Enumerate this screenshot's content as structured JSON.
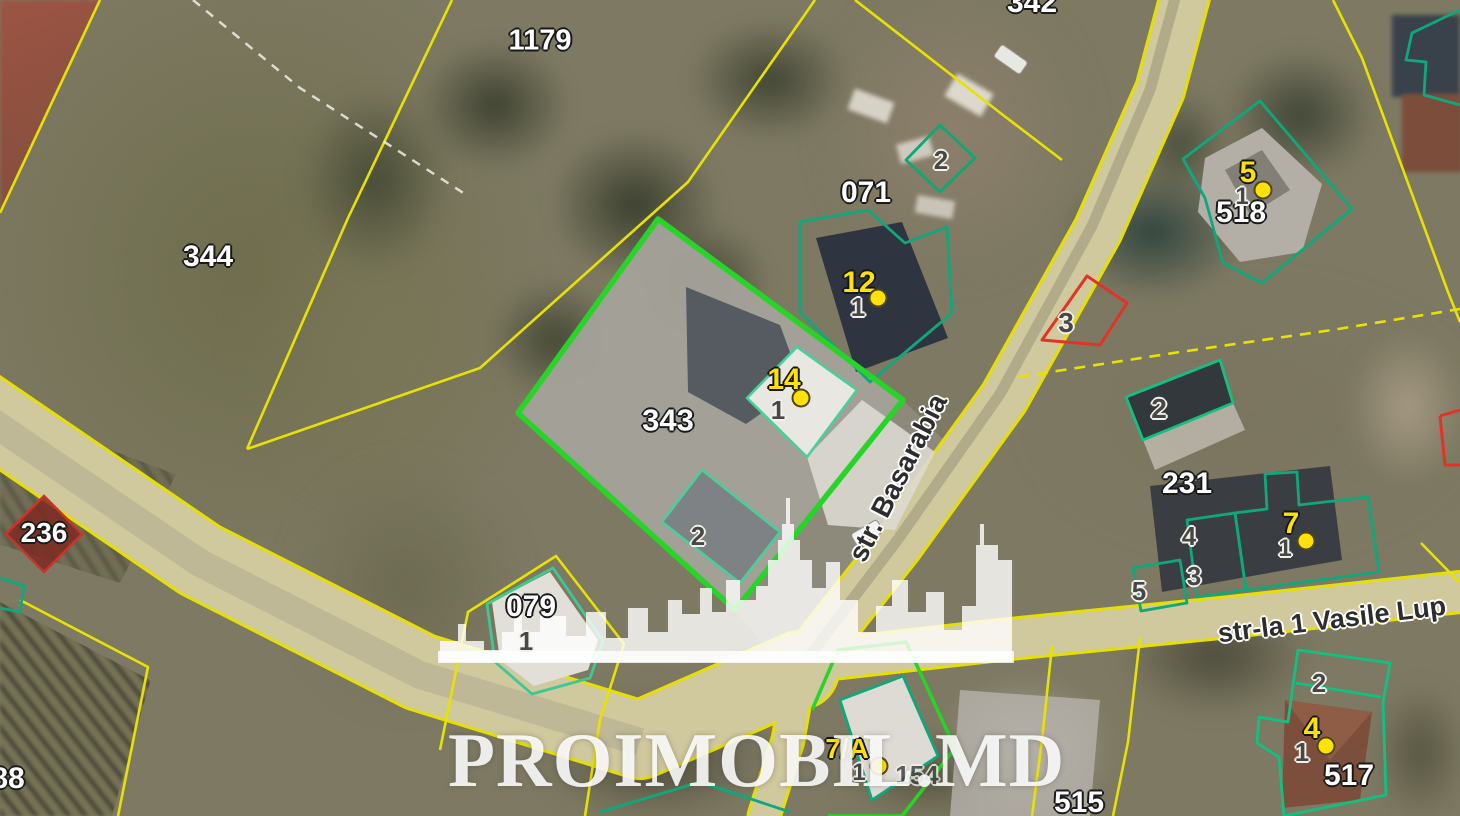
{
  "map_type": "cadastral-satellite-view",
  "watermark": {
    "text": "PROIMOBIL.MD"
  },
  "streets": {
    "basarabia": "str. Basarabia",
    "vasile_lupu": "str-la 1 Vasile Lup"
  },
  "parcels": {
    "p1179": "1179",
    "p344": "344",
    "p342": "342",
    "p071": "071",
    "p343": "343",
    "p518": "518",
    "p231": "231",
    "p079": "079",
    "p236": "236",
    "p515": "515",
    "p517": "517",
    "p88": "88"
  },
  "sub_labels": {
    "s1_079": "1",
    "s2_343": "2",
    "s1_14": "1",
    "s1_12": "1",
    "s2_071": "2",
    "s1_5": "1",
    "s3_red": "3",
    "s2_231": "2",
    "s4_231": "4",
    "s3_231": "3",
    "s5_231": "5",
    "s1_7": "1",
    "s2_517": "2",
    "s1_4": "1",
    "s1_7a": "1",
    "s154": "154"
  },
  "markers": {
    "m12": {
      "label": "12"
    },
    "m14": {
      "label": "14"
    },
    "m5": {
      "label": "5"
    },
    "m7": {
      "label": "7"
    },
    "m4": {
      "label": "4"
    },
    "m7a": {
      "label": "7/A"
    }
  },
  "colors": {
    "parcel_line_yellow": "#e8e104",
    "highlight_parcel_green": "#27d427",
    "building_outline_teal": "#0fa87c",
    "alert_outline_red": "#e23326",
    "marker_yellow": "#ffe10a",
    "road_fill": "#d0c99e",
    "watermark_white": "#ffffff"
  }
}
